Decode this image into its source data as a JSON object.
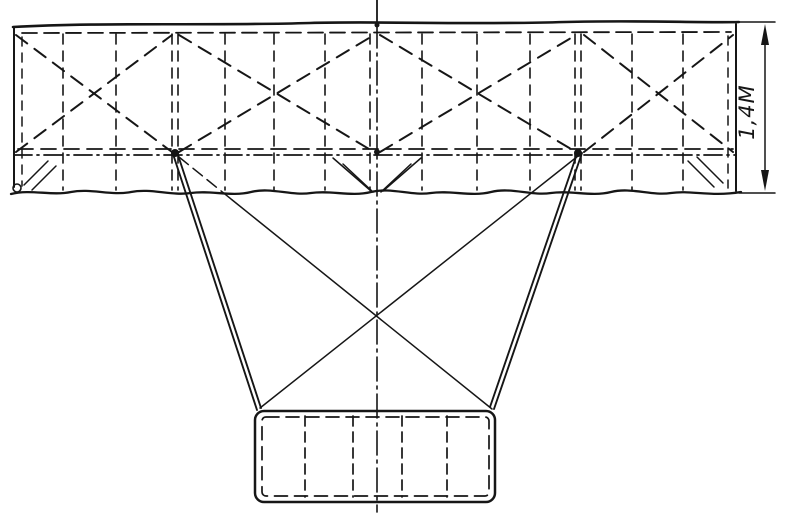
{
  "figure": {
    "kind": "hand-drawn structural sketch",
    "background": "#ffffff",
    "ink": "#161616"
  },
  "dimension": {
    "label": "1,4M"
  },
  "drawing": {
    "width": 787,
    "height": 517,
    "ink": "#161616",
    "groups": [
      {
        "name": "wing-panel-outline",
        "els": [
          {
            "t": "path",
            "name": "leading-edge",
            "d": "M13,27 C100,22 210,26 310,23 C380,21 470,25 565,22 C640,20 700,23 739,22",
            "w": 2.6
          },
          {
            "t": "line",
            "name": "left-tip-edge",
            "x1": 14,
            "y1": 27,
            "x2": 14,
            "y2": 187,
            "w": 2
          },
          {
            "t": "line",
            "name": "right-tip-edge",
            "x1": 736,
            "y1": 24,
            "x2": 736,
            "y2": 191,
            "w": 2
          },
          {
            "t": "path",
            "name": "trailing-edge",
            "d": "M11,194 C31,189 51,196 71,192 S111,196 131,192 S171,196 191,193 S231,197 251,192 S291,196 311,193 S351,197 371,192 S411,196 431,193 S471,197 491,192 S531,196 551,193 S591,197 611,192 S651,196 671,193 S711,197 741,192",
            "w": 2.3
          },
          {
            "t": "circle",
            "name": "corner-loop",
            "cx": 17,
            "cy": 188,
            "r": 4,
            "w": 1.6
          }
        ]
      },
      {
        "name": "wing-inner-dashed-frame",
        "els": [
          {
            "t": "line",
            "x1": 22,
            "y1": 33,
            "x2": 731,
            "y2": 32,
            "dash": "15 7",
            "w": 1.8
          },
          {
            "t": "line",
            "x1": 22,
            "y1": 37,
            "x2": 22,
            "y2": 186,
            "dash": "9 7",
            "w": 1.5
          },
          {
            "t": "line",
            "x1": 728,
            "y1": 36,
            "x2": 728,
            "y2": 188,
            "dash": "9 7",
            "w": 1.5
          },
          {
            "t": "line",
            "x1": 18,
            "y1": 149,
            "x2": 733,
            "y2": 149,
            "dash": "15 8",
            "w": 1.8
          }
        ]
      },
      {
        "name": "spar-axis-line",
        "els": [
          {
            "t": "line",
            "x1": 14,
            "y1": 155,
            "x2": 736,
            "y2": 155,
            "dash": "18 5 2 5",
            "w": 1.8
          }
        ]
      },
      {
        "name": "wing-ribs",
        "els": [
          {
            "t": "line",
            "x1": 63,
            "y1": 34,
            "x2": 63,
            "y2": 190,
            "dash": "10 7",
            "w": 1.6
          },
          {
            "t": "line",
            "x1": 116,
            "y1": 34,
            "x2": 116,
            "y2": 190,
            "dash": "10 7",
            "w": 1.6
          },
          {
            "t": "line",
            "x1": 172,
            "y1": 34,
            "x2": 172,
            "y2": 190,
            "dash": "10 7",
            "w": 1.6
          },
          {
            "t": "line",
            "x1": 178,
            "y1": 34,
            "x2": 178,
            "y2": 190,
            "dash": "10 7",
            "w": 1.6
          },
          {
            "t": "line",
            "x1": 225,
            "y1": 34,
            "x2": 225,
            "y2": 190,
            "dash": "10 7",
            "w": 1.6
          },
          {
            "t": "line",
            "x1": 274,
            "y1": 34,
            "x2": 274,
            "y2": 190,
            "dash": "10 7",
            "w": 1.6
          },
          {
            "t": "line",
            "x1": 325,
            "y1": 34,
            "x2": 325,
            "y2": 190,
            "dash": "10 7",
            "w": 1.6
          },
          {
            "t": "line",
            "x1": 370,
            "y1": 34,
            "x2": 370,
            "y2": 190,
            "dash": "10 7",
            "w": 1.6
          },
          {
            "t": "line",
            "x1": 422,
            "y1": 34,
            "x2": 422,
            "y2": 190,
            "dash": "10 7",
            "w": 1.6
          },
          {
            "t": "line",
            "x1": 477,
            "y1": 34,
            "x2": 477,
            "y2": 190,
            "dash": "10 7",
            "w": 1.6
          },
          {
            "t": "line",
            "x1": 530,
            "y1": 34,
            "x2": 530,
            "y2": 190,
            "dash": "10 7",
            "w": 1.6
          },
          {
            "t": "line",
            "x1": 575,
            "y1": 34,
            "x2": 575,
            "y2": 190,
            "dash": "10 7",
            "w": 1.6
          },
          {
            "t": "line",
            "x1": 581,
            "y1": 34,
            "x2": 581,
            "y2": 190,
            "dash": "10 7",
            "w": 1.6
          },
          {
            "t": "line",
            "x1": 632,
            "y1": 34,
            "x2": 632,
            "y2": 190,
            "dash": "10 7",
            "w": 1.6
          },
          {
            "t": "line",
            "x1": 683,
            "y1": 34,
            "x2": 683,
            "y2": 190,
            "dash": "10 7",
            "w": 1.6
          }
        ]
      },
      {
        "name": "wing-x-bracing",
        "els": [
          {
            "t": "line",
            "x1": 16,
            "y1": 35,
            "x2": 172,
            "y2": 152,
            "dash": "14 9",
            "w": 2
          },
          {
            "t": "line",
            "x1": 16,
            "y1": 152,
            "x2": 172,
            "y2": 35,
            "dash": "14 9",
            "w": 2
          },
          {
            "t": "line",
            "x1": 179,
            "y1": 35,
            "x2": 374,
            "y2": 152,
            "dash": "14 9",
            "w": 2
          },
          {
            "t": "line",
            "x1": 179,
            "y1": 152,
            "x2": 374,
            "y2": 35,
            "dash": "14 9",
            "w": 2
          },
          {
            "t": "line",
            "x1": 380,
            "y1": 35,
            "x2": 576,
            "y2": 152,
            "dash": "14 9",
            "w": 2
          },
          {
            "t": "line",
            "x1": 380,
            "y1": 152,
            "x2": 576,
            "y2": 35,
            "dash": "14 9",
            "w": 2
          },
          {
            "t": "line",
            "x1": 584,
            "y1": 35,
            "x2": 733,
            "y2": 152,
            "dash": "14 9",
            "w": 2
          },
          {
            "t": "line",
            "x1": 584,
            "y1": 152,
            "x2": 733,
            "y2": 35,
            "dash": "14 9",
            "w": 2
          }
        ]
      },
      {
        "name": "strut-joints",
        "els": [
          {
            "t": "circle",
            "name": "left-strut-joint",
            "cx": 175,
            "cy": 153,
            "r": 4,
            "f": "#161616"
          },
          {
            "t": "circle",
            "name": "right-strut-joint",
            "cx": 578,
            "cy": 153,
            "r": 4,
            "f": "#161616"
          },
          {
            "t": "circle",
            "name": "center-spar-joint",
            "cx": 377,
            "cy": 152,
            "r": 3,
            "f": "#161616"
          },
          {
            "t": "circle",
            "name": "center-top-joint",
            "cx": 377,
            "cy": 25,
            "r": 2.5,
            "f": "#161616"
          }
        ]
      },
      {
        "name": "trailing-strip-ticks",
        "els": [
          {
            "t": "line",
            "x1": 24,
            "y1": 185,
            "x2": 48,
            "y2": 161,
            "w": 1.5
          },
          {
            "t": "line",
            "x1": 32,
            "y1": 190,
            "x2": 56,
            "y2": 166,
            "w": 1.5
          },
          {
            "t": "line",
            "x1": 333,
            "y1": 158,
            "x2": 371,
            "y2": 191,
            "w": 1.5
          },
          {
            "t": "line",
            "x1": 343,
            "y1": 164,
            "x2": 373,
            "y2": 192,
            "w": 1.5
          },
          {
            "t": "line",
            "x1": 421,
            "y1": 158,
            "x2": 383,
            "y2": 191,
            "w": 1.5
          },
          {
            "t": "line",
            "x1": 411,
            "y1": 164,
            "x2": 381,
            "y2": 192,
            "w": 1.5
          },
          {
            "t": "line",
            "x1": 688,
            "y1": 161,
            "x2": 714,
            "y2": 187,
            "w": 1.5
          },
          {
            "t": "line",
            "x1": 697,
            "y1": 157,
            "x2": 723,
            "y2": 183,
            "w": 1.5
          }
        ]
      },
      {
        "name": "pylon-struts",
        "els": [
          {
            "t": "line",
            "name": "left-strut-outer",
            "x1": 173,
            "y1": 154,
            "x2": 257,
            "y2": 410,
            "w": 1.9
          },
          {
            "t": "line",
            "name": "left-strut-inner",
            "x1": 177,
            "y1": 152,
            "x2": 261,
            "y2": 408,
            "w": 1.9
          },
          {
            "t": "line",
            "name": "right-strut-outer",
            "x1": 582,
            "y1": 153,
            "x2": 494,
            "y2": 409,
            "w": 1.9
          },
          {
            "t": "line",
            "name": "right-strut-inner",
            "x1": 578,
            "y1": 151,
            "x2": 490,
            "y2": 407,
            "w": 1.9
          }
        ]
      },
      {
        "name": "pylon-cross-bracing",
        "els": [
          {
            "t": "line",
            "x1": 179,
            "y1": 157,
            "x2": 231,
            "y2": 199,
            "dash": "12 6",
            "w": 1.5
          },
          {
            "t": "line",
            "x1": 231,
            "y1": 199,
            "x2": 492,
            "y2": 409,
            "w": 1.5
          },
          {
            "t": "line",
            "x1": 578,
            "y1": 156,
            "x2": 260,
            "y2": 408,
            "w": 1.5
          }
        ]
      },
      {
        "name": "symmetry-axis",
        "els": [
          {
            "t": "line",
            "x1": 377,
            "y1": 0,
            "x2": 377,
            "y2": 24,
            "w": 1.8
          },
          {
            "t": "line",
            "x1": 377,
            "y1": 24,
            "x2": 377,
            "y2": 512,
            "dash": "24 5 3 5",
            "w": 1.6
          }
        ]
      },
      {
        "name": "bottom-panel",
        "els": [
          {
            "t": "rect",
            "name": "bottom-panel-outline",
            "x": 255,
            "y": 411,
            "wd": 240,
            "h": 91,
            "rx": 9,
            "w": 2.5
          },
          {
            "t": "rect",
            "name": "bottom-panel-inner-dashed",
            "x": 262,
            "y": 417,
            "wd": 227,
            "h": 79,
            "rx": 4,
            "dash": "13 7",
            "w": 1.7
          },
          {
            "t": "line",
            "x1": 305,
            "y1": 416,
            "x2": 305,
            "y2": 497,
            "dash": "10 6",
            "w": 1.7
          },
          {
            "t": "line",
            "x1": 353,
            "y1": 416,
            "x2": 353,
            "y2": 497,
            "dash": "10 6",
            "w": 1.7
          },
          {
            "t": "line",
            "x1": 402,
            "y1": 416,
            "x2": 402,
            "y2": 497,
            "dash": "10 6",
            "w": 1.7
          },
          {
            "t": "line",
            "x1": 447,
            "y1": 416,
            "x2": 447,
            "y2": 497,
            "dash": "10 6",
            "w": 1.7
          }
        ]
      },
      {
        "name": "dimension-annotation",
        "els": [
          {
            "t": "line",
            "name": "extension-line-top",
            "x1": 739,
            "y1": 22,
            "x2": 775,
            "y2": 22,
            "w": 1.5
          },
          {
            "t": "line",
            "name": "extension-line-bottom",
            "x1": 739,
            "y1": 193,
            "x2": 775,
            "y2": 193,
            "w": 1.5
          },
          {
            "t": "line",
            "name": "dimension-line",
            "x1": 765,
            "y1": 30,
            "x2": 765,
            "y2": 185,
            "w": 1.5
          },
          {
            "t": "polygon",
            "name": "arrowhead-up-icon",
            "pts": "765,24 761,45 769,45",
            "f": "#161616"
          },
          {
            "t": "polygon",
            "name": "arrowhead-down-icon",
            "pts": "765,191 761,170 769,170",
            "f": "#161616"
          },
          {
            "t": "text",
            "name": "dimension-label",
            "x": 748,
            "y": 112,
            "rot": -90,
            "size": 21,
            "bind": "dimension.label"
          }
        ]
      }
    ]
  }
}
